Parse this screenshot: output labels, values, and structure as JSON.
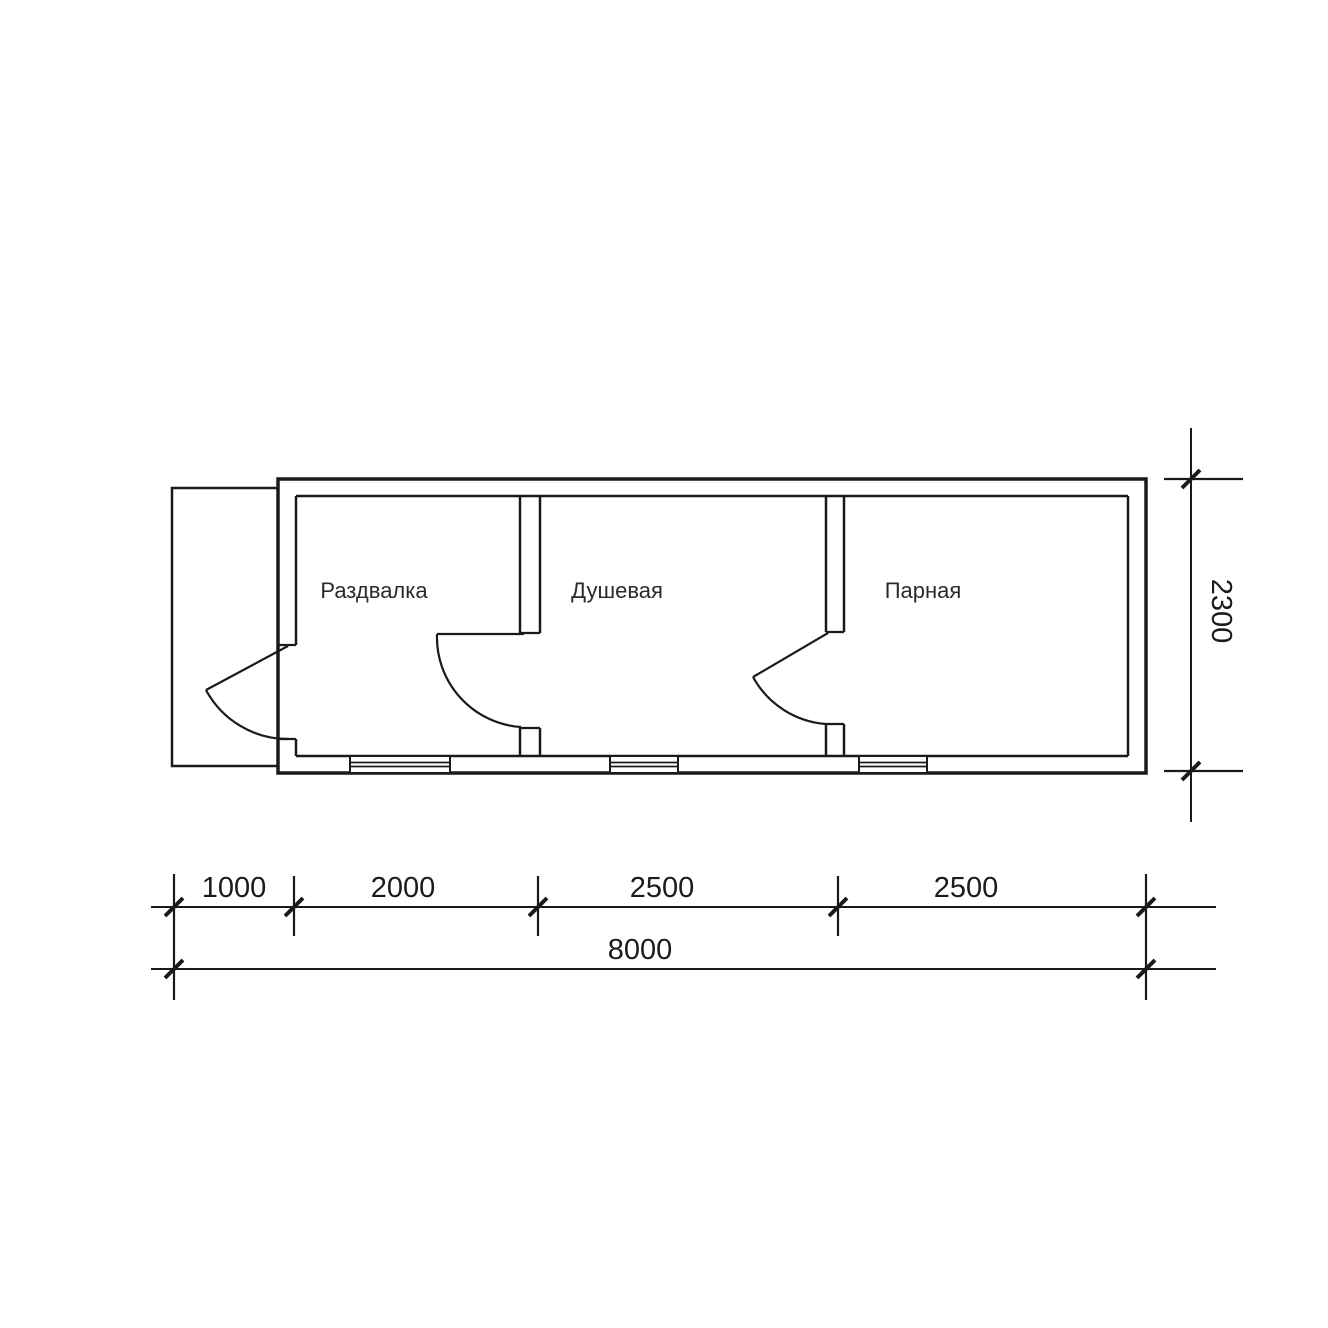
{
  "plan": {
    "rooms": [
      {
        "label": "Раздвалка"
      },
      {
        "label": "Душевая"
      },
      {
        "label": "Парная"
      }
    ],
    "dimensions": {
      "bottom_segments": [
        "1000",
        "2000",
        "2500",
        "2500"
      ],
      "bottom_total": "8000",
      "right_height": "2300"
    }
  },
  "colors": {
    "line": "#1a1a1a",
    "background": "#ffffff",
    "label_text": "#2a2a2a",
    "dimension_text": "#1b1b1b"
  }
}
